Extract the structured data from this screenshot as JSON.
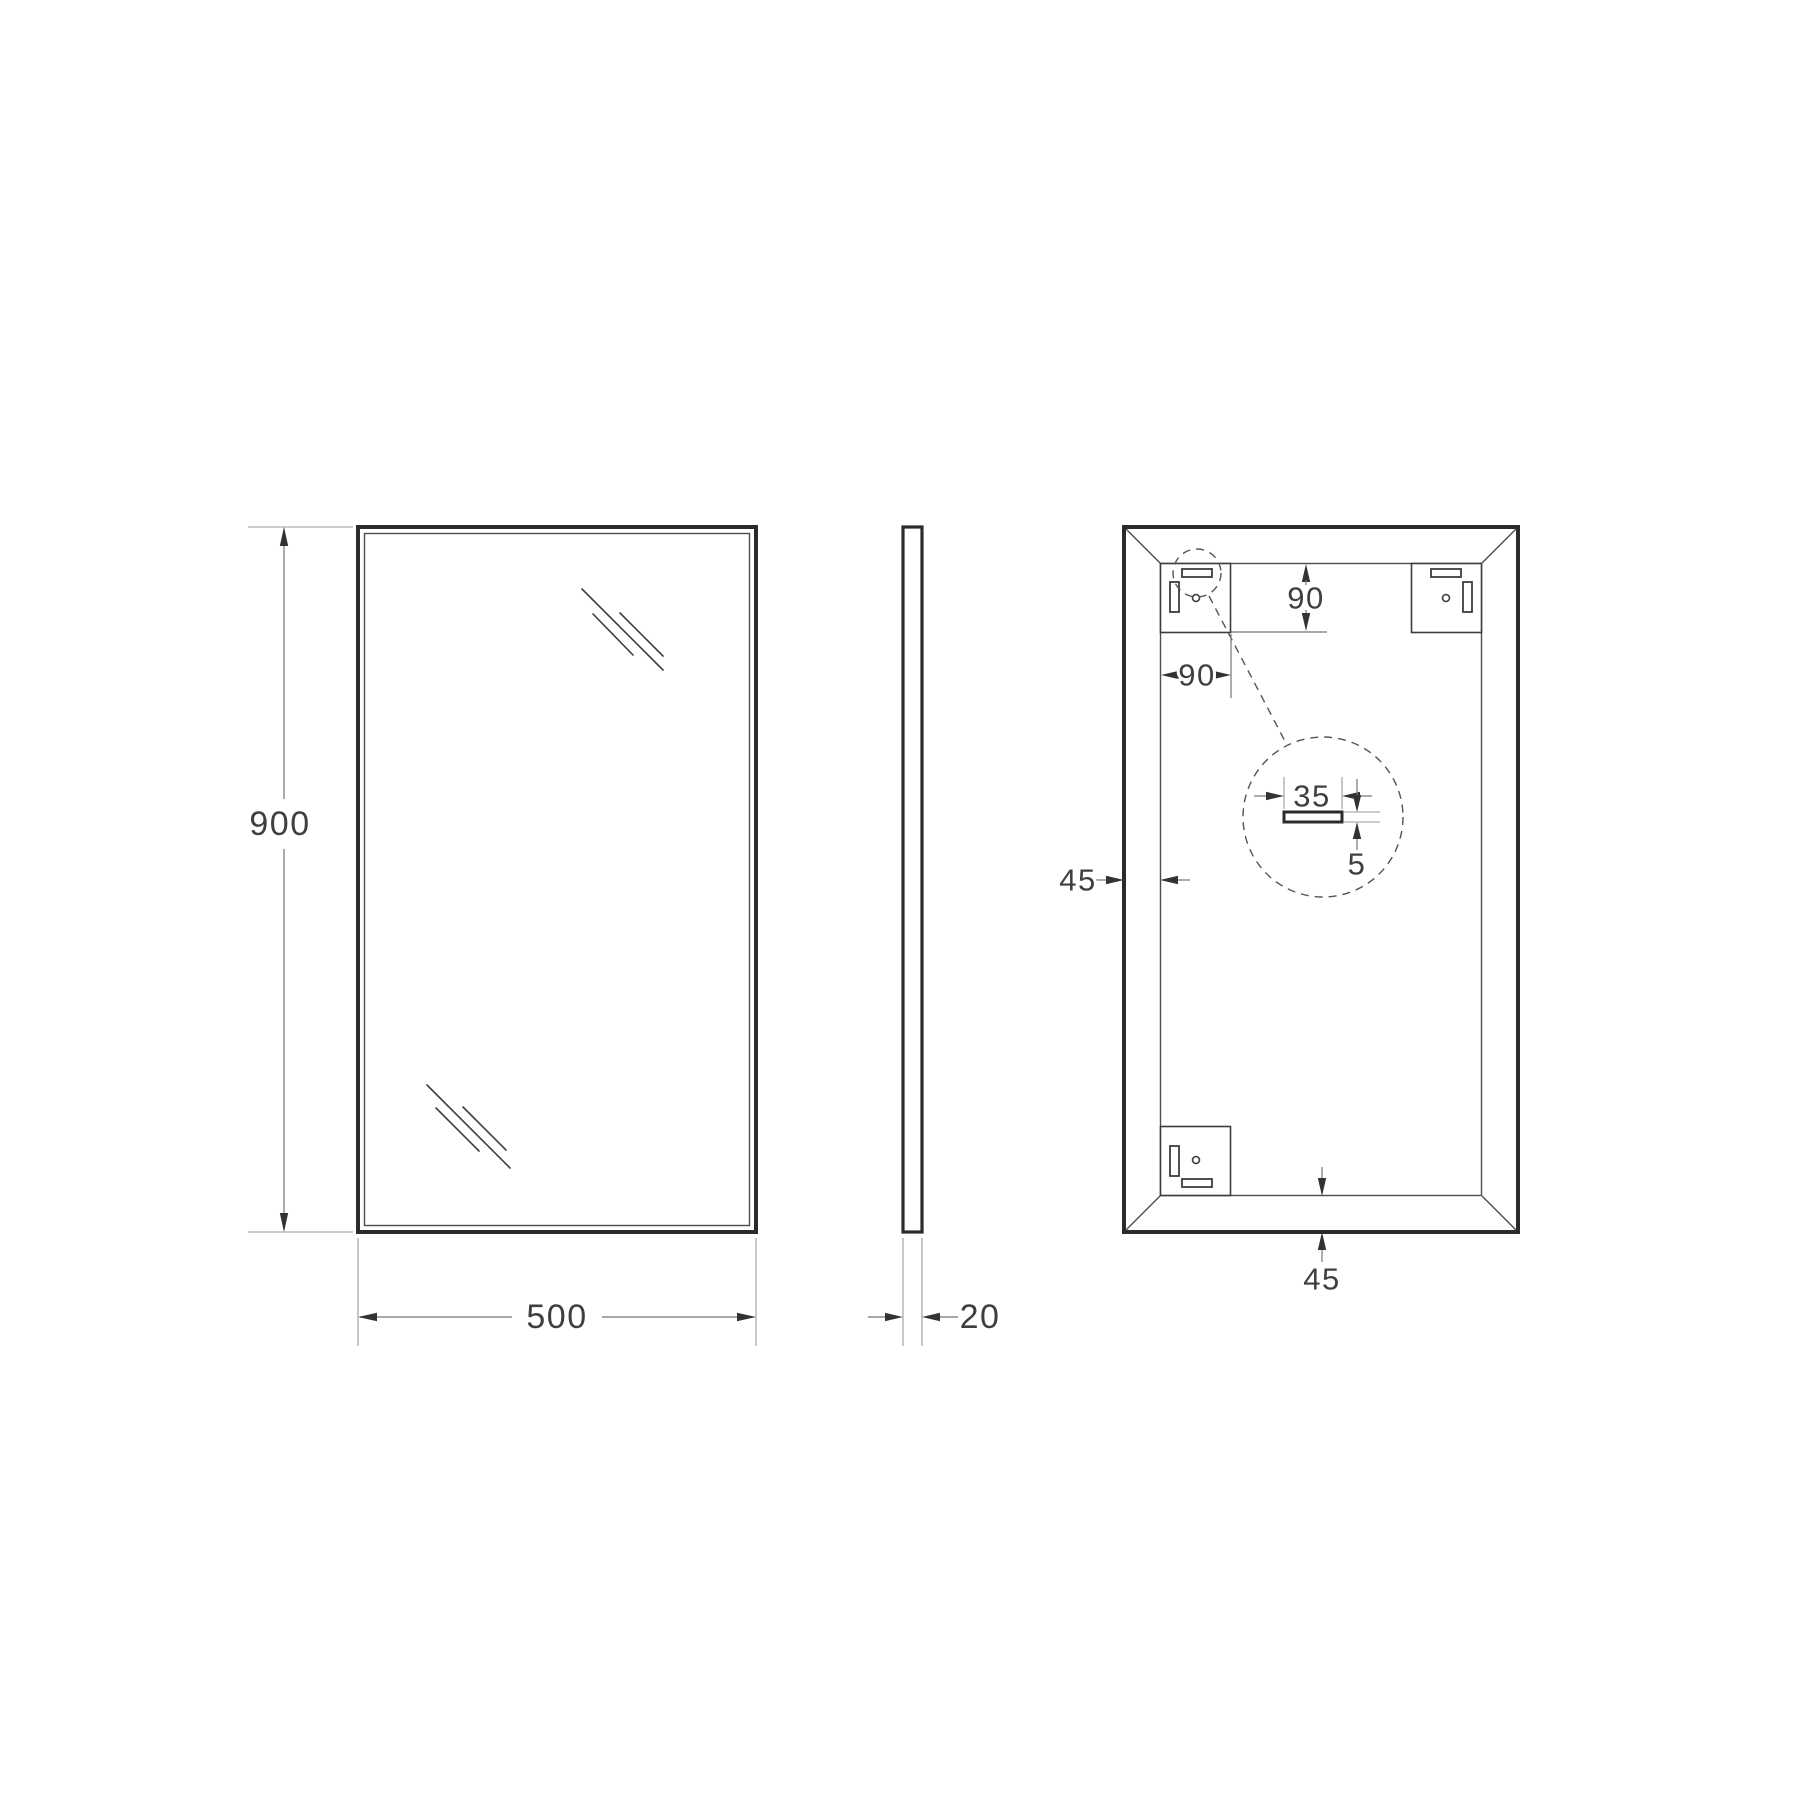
{
  "drawing": {
    "background_color": "#ffffff",
    "line_color": "#2b2b2b",
    "dimension_line_color": "#757575",
    "text_color": "#3f3f3f",
    "front_view": {
      "height_mm": "900",
      "width_mm": "500"
    },
    "side_view": {
      "thickness_mm": "20"
    },
    "back_view": {
      "hanger_offset_top_mm": "90",
      "hanger_offset_side_mm": "90",
      "frame_width_left_mm": "45",
      "frame_width_bottom_mm": "45",
      "detail": {
        "slot_width_mm": "35",
        "slot_thickness_mm": "5"
      }
    }
  }
}
